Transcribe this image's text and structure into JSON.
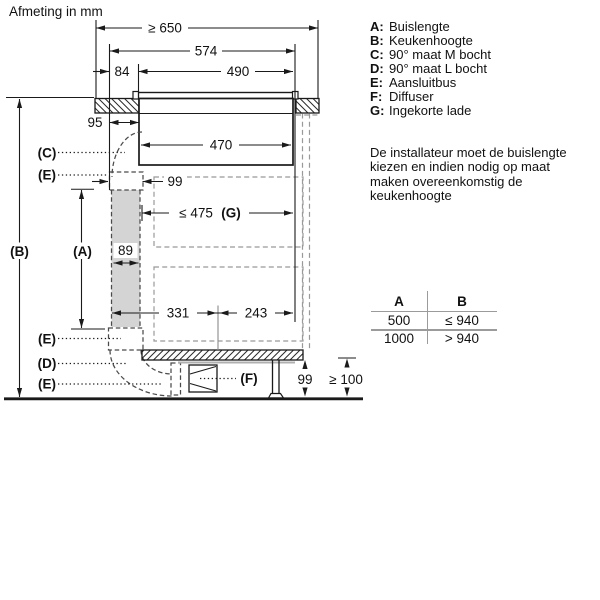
{
  "title": "Afmeting in mm",
  "legend": {
    "items": [
      {
        "key": "A:",
        "label": "Buislengte"
      },
      {
        "key": "B:",
        "label": "Keukenhoogte"
      },
      {
        "key": "C:",
        "label": "90° maat M bocht"
      },
      {
        "key": "D:",
        "label": "90° maat L bocht"
      },
      {
        "key": "E:",
        "label": "Aansluitbus"
      },
      {
        "key": "F:",
        "label": "Diffuser"
      },
      {
        "key": "G:",
        "label": "Ingekorte lade"
      }
    ]
  },
  "note": {
    "lines": [
      "De installateur moet de buislengte",
      "kiezen en indien nodig op maat",
      "maken overeenkomstig de",
      "keukenhoogte"
    ]
  },
  "table": {
    "headers": [
      "A",
      "B"
    ],
    "rows": [
      [
        "500",
        "≤ 940"
      ],
      [
        "1000",
        "> 940"
      ]
    ]
  },
  "dimensions": {
    "worktop_min": "≥ 650",
    "d574": "574",
    "d84": "84",
    "d490": "490",
    "d95": "95",
    "d470": "470",
    "d99_top": "99",
    "drawer_max": "≤ 475",
    "drawer_ref": "(G)",
    "d89": "89",
    "d331": "331",
    "d243": "243",
    "d99_bottom": "99",
    "plinth_min": "≥ 100"
  },
  "labels": {
    "A": "(A)",
    "B": "(B)",
    "C": "(C)",
    "D": "(D)",
    "E": "(E)",
    "F": "(F)"
  }
}
